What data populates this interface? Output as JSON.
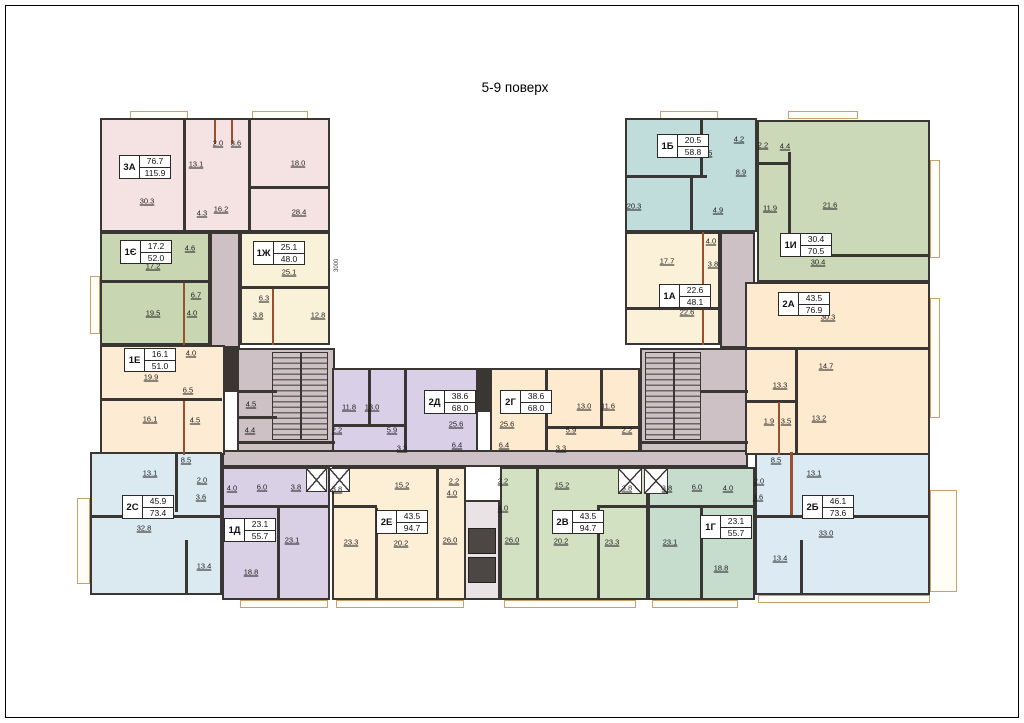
{
  "floor_label": "5-9 поверх",
  "palette": {
    "wall": "#3a3634",
    "partition": "#9b4f2c",
    "balcony_line": "#c9a26b",
    "corridor": "#cdc1c5",
    "paper": "#ffffff"
  },
  "plan": {
    "apartments": [
      {
        "id": "3А",
        "living": "76.7",
        "total": "115.9",
        "color": "#f5e3e3",
        "rect": [
          100,
          118,
          230,
          114
        ],
        "label": [
          119,
          155
        ],
        "rooms": [
          [
            "30.3",
            147,
            201
          ],
          [
            "13.1",
            196,
            164
          ],
          [
            "2.0",
            218,
            143
          ],
          [
            "3.6",
            236,
            143
          ],
          [
            "18.0",
            298,
            163
          ],
          [
            "4.3",
            202,
            213
          ],
          [
            "16.2",
            221,
            209
          ],
          [
            "28.4",
            299,
            212
          ]
        ]
      },
      {
        "id": "1Є",
        "living": "17.2",
        "total": "52.0",
        "color": "#c9d6b2",
        "rect": [
          100,
          232,
          110,
          113
        ],
        "label": [
          120,
          240
        ],
        "rooms": [
          [
            "17.2",
            153,
            266
          ],
          [
            "4.6",
            190,
            248
          ],
          [
            "6.7",
            196,
            295
          ],
          [
            "19.5",
            153,
            313
          ],
          [
            "4.0",
            192,
            313
          ]
        ]
      },
      {
        "id": "1Ж",
        "living": "25.1",
        "total": "48.0",
        "color": "#f9f2d8",
        "rect": [
          240,
          232,
          90,
          113
        ],
        "label": [
          253,
          241
        ],
        "rooms": [
          [
            "25.1",
            289,
            272
          ],
          [
            "6.3",
            264,
            298
          ],
          [
            "3.8",
            258,
            315
          ],
          [
            "12.8",
            318,
            315
          ]
        ]
      },
      {
        "id": "1Е",
        "living": "16.1",
        "total": "51.0",
        "color": "#fdecd3",
        "rect": [
          100,
          345,
          125,
          110
        ],
        "label": [
          124,
          348
        ],
        "rooms": [
          [
            "4.0",
            191,
            353
          ],
          [
            "19.9",
            151,
            377
          ],
          [
            "6.5",
            188,
            390
          ],
          [
            "16.1",
            150,
            419
          ],
          [
            "4.5",
            195,
            420
          ]
        ]
      },
      {
        "id": "2С",
        "living": "45.9",
        "total": "73.4",
        "color": "#dbe9f1",
        "rect": [
          90,
          452,
          132,
          143
        ],
        "label": [
          122,
          495
        ],
        "rooms": [
          [
            "8.5",
            186,
            460
          ],
          [
            "13.1",
            150,
            473
          ],
          [
            "2.0",
            202,
            480
          ],
          [
            "3.6",
            201,
            497
          ],
          [
            "32.8",
            144,
            528
          ],
          [
            "13.4",
            204,
            566
          ]
        ]
      },
      {
        "id": "1Д",
        "living": "23.1",
        "total": "55.7",
        "color": "#d9d0e5",
        "rect": [
          222,
          467,
          108,
          133
        ],
        "label": [
          224,
          518
        ],
        "rooms": [
          [
            "4.0",
            232,
            488
          ],
          [
            "6.0",
            262,
            487
          ],
          [
            "3.8",
            296,
            487
          ],
          [
            "23.1",
            292,
            540
          ],
          [
            "18.8",
            251,
            572
          ]
        ]
      },
      {
        "id": "2Е",
        "living": "43.5",
        "total": "94.7",
        "color": "#fdeed6",
        "rect": [
          332,
          467,
          134,
          133
        ],
        "label": [
          376,
          510
        ],
        "rooms": [
          [
            "3.8",
            337,
            489
          ],
          [
            "15.2",
            402,
            485
          ],
          [
            "2.2",
            454,
            481
          ],
          [
            "4.0",
            452,
            493
          ],
          [
            "23.3",
            351,
            542
          ],
          [
            "20.2",
            401,
            543
          ],
          [
            "26.0",
            450,
            540
          ]
        ]
      },
      {
        "id": "2Д",
        "living": "38.6",
        "total": "68.0",
        "color": "#d9d0e7",
        "rect": [
          332,
          368,
          146,
          84
        ],
        "label": [
          424,
          390
        ],
        "rooms": [
          [
            "11.8",
            349,
            407
          ],
          [
            "13.0",
            372,
            407
          ],
          [
            "2.2",
            337,
            430
          ],
          [
            "5.9",
            392,
            430
          ],
          [
            "3.3",
            402,
            448
          ],
          [
            "25.6",
            456,
            424
          ],
          [
            "6.4",
            457,
            445
          ]
        ]
      },
      {
        "id": "2Г",
        "living": "38.6",
        "total": "68.0",
        "color": "#fdeacf",
        "rect": [
          490,
          368,
          150,
          84
        ],
        "label": [
          500,
          390
        ],
        "rooms": [
          [
            "25.6",
            507,
            424
          ],
          [
            "6.4",
            504,
            445
          ],
          [
            "3.3",
            561,
            448
          ],
          [
            "5.9",
            571,
            430
          ],
          [
            "2.2",
            627,
            430
          ],
          [
            "13.0",
            584,
            406
          ],
          [
            "11.6",
            608,
            406
          ]
        ]
      },
      {
        "id": "2В",
        "living": "43.5",
        "total": "94.7",
        "color": "#d3e1c3",
        "rect": [
          500,
          467,
          148,
          133
        ],
        "label": [
          552,
          510
        ],
        "rooms": [
          [
            "2.2",
            503,
            481
          ],
          [
            "15.2",
            562,
            485
          ],
          [
            "4.0",
            503,
            508
          ],
          [
            "3.8",
            627,
            488
          ],
          [
            "26.0",
            512,
            540
          ],
          [
            "20.2",
            561,
            541
          ],
          [
            "23.3",
            612,
            542
          ]
        ]
      },
      {
        "id": "1Г",
        "living": "23.1",
        "total": "55.7",
        "color": "#c6dccd",
        "rect": [
          648,
          467,
          107,
          133
        ],
        "label": [
          700,
          515
        ],
        "rooms": [
          [
            "3.8",
            667,
            488
          ],
          [
            "6.0",
            697,
            487
          ],
          [
            "4.0",
            728,
            488
          ],
          [
            "23.1",
            670,
            542
          ],
          [
            "18.8",
            721,
            568
          ]
        ]
      },
      {
        "id": "2Б",
        "living": "46.1",
        "total": "73.6",
        "color": "#dcebf3",
        "rect": [
          755,
          452,
          175,
          143
        ],
        "label": [
          802,
          495
        ],
        "rooms": [
          [
            "8.5",
            776,
            460
          ],
          [
            "13.1",
            814,
            473
          ],
          [
            "2.0",
            759,
            481
          ],
          [
            "3.6",
            758,
            497
          ],
          [
            "33.0",
            826,
            533
          ],
          [
            "13.4",
            780,
            558
          ]
        ]
      },
      {
        "id": "1А",
        "living": "22.6",
        "total": "48.1",
        "color": "#faf1d8",
        "rect": [
          625,
          232,
          95,
          113
        ],
        "label": [
          659,
          284
        ],
        "rooms": [
          [
            "17.7",
            667,
            261
          ],
          [
            "4.0",
            711,
            241
          ],
          [
            "3.8",
            713,
            264
          ],
          [
            "22.6",
            687,
            312
          ]
        ]
      },
      {
        "id": "2А",
        "living": "43.5",
        "total": "76.9",
        "color": "#fdeacf",
        "rect": [
          745,
          282,
          185,
          173
        ],
        "label": [
          778,
          292
        ],
        "rooms": [
          [
            "30.3",
            828,
            317
          ],
          [
            "14.7",
            826,
            366
          ],
          [
            "13.3",
            780,
            385
          ],
          [
            "1.9",
            769,
            421
          ],
          [
            "3.5",
            786,
            421
          ],
          [
            "13.2",
            819,
            418
          ]
        ]
      },
      {
        "id": "1Б",
        "living": "20.5",
        "total": "58.8",
        "color": "#c0dcdb",
        "rect": [
          625,
          118,
          132,
          114
        ],
        "label": [
          657,
          134
        ],
        "rooms": [
          [
            "20.5",
            705,
            153
          ],
          [
            "4.2",
            739,
            139
          ],
          [
            "8.9",
            741,
            172
          ],
          [
            "20.3",
            634,
            206
          ],
          [
            "4.9",
            718,
            210
          ]
        ]
      },
      {
        "id": "1И",
        "living": "30.4",
        "total": "70.5",
        "color": "#ccd9b8",
        "rect": [
          757,
          120,
          173,
          162
        ],
        "label": [
          780,
          233
        ],
        "rooms": [
          [
            "2.2",
            763,
            145
          ],
          [
            "4.4",
            785,
            146
          ],
          [
            "11.9",
            770,
            208
          ],
          [
            "21.6",
            830,
            205
          ],
          [
            "30.4",
            818,
            262
          ]
        ]
      }
    ],
    "corridors": [
      [
        210,
        232,
        30,
        116
      ],
      [
        237,
        348,
        98,
        104
      ],
      [
        222,
        450,
        526,
        17
      ],
      [
        640,
        348,
        108,
        104
      ],
      [
        720,
        232,
        35,
        116
      ]
    ],
    "corridor_rooms": [
      [
        "4.5",
        251,
        404
      ],
      [
        "4.4",
        250,
        430
      ]
    ],
    "stairs": [
      [
        272,
        352,
        56,
        88
      ],
      [
        645,
        352,
        56,
        88
      ]
    ],
    "shafts": [
      [
        306,
        468,
        21,
        24
      ],
      [
        329,
        468,
        21,
        24
      ],
      [
        618,
        468,
        24,
        26
      ],
      [
        644,
        468,
        24,
        26
      ]
    ],
    "elevator": {
      "box": [
        464,
        500,
        36,
        100
      ],
      "cars": [
        [
          468,
          528,
          28,
          26
        ],
        [
          468,
          557,
          28,
          26
        ]
      ]
    },
    "walls": [
      [
        183,
        120,
        3,
        112,
        "d"
      ],
      [
        248,
        120,
        3,
        112,
        "d"
      ],
      [
        251,
        186,
        79,
        3,
        "d"
      ],
      [
        214,
        120,
        2,
        24,
        "b"
      ],
      [
        231,
        120,
        2,
        24,
        "b"
      ],
      [
        100,
        280,
        108,
        3,
        "d"
      ],
      [
        183,
        283,
        2,
        62,
        "b"
      ],
      [
        240,
        286,
        88,
        3,
        "d"
      ],
      [
        272,
        289,
        2,
        56,
        "b"
      ],
      [
        100,
        398,
        122,
        3,
        "d"
      ],
      [
        183,
        401,
        2,
        54,
        "b"
      ],
      [
        175,
        452,
        3,
        60,
        "d"
      ],
      [
        90,
        515,
        132,
        3,
        "d"
      ],
      [
        185,
        540,
        3,
        55,
        "d"
      ],
      [
        222,
        505,
        108,
        3,
        "d"
      ],
      [
        277,
        508,
        3,
        92,
        "d"
      ],
      [
        436,
        467,
        3,
        133,
        "d"
      ],
      [
        375,
        508,
        3,
        92,
        "d"
      ],
      [
        332,
        505,
        45,
        3,
        "d"
      ],
      [
        368,
        368,
        3,
        56,
        "d"
      ],
      [
        404,
        368,
        3,
        84,
        "d"
      ],
      [
        332,
        424,
        72,
        3,
        "d"
      ],
      [
        545,
        368,
        3,
        84,
        "d"
      ],
      [
        600,
        368,
        3,
        58,
        "d"
      ],
      [
        545,
        426,
        95,
        3,
        "d"
      ],
      [
        536,
        467,
        3,
        133,
        "d"
      ],
      [
        597,
        508,
        3,
        92,
        "d"
      ],
      [
        597,
        505,
        50,
        3,
        "d"
      ],
      [
        648,
        505,
        107,
        3,
        "d"
      ],
      [
        700,
        508,
        3,
        92,
        "d"
      ],
      [
        755,
        515,
        175,
        3,
        "d"
      ],
      [
        800,
        540,
        3,
        55,
        "d"
      ],
      [
        790,
        452,
        3,
        63,
        "b"
      ],
      [
        702,
        232,
        2,
        113,
        "b"
      ],
      [
        625,
        307,
        95,
        3,
        "d"
      ],
      [
        745,
        347,
        185,
        3,
        "d"
      ],
      [
        795,
        349,
        3,
        106,
        "d"
      ],
      [
        745,
        400,
        52,
        3,
        "d"
      ],
      [
        778,
        402,
        2,
        53,
        "b"
      ],
      [
        625,
        175,
        82,
        3,
        "d"
      ],
      [
        690,
        177,
        3,
        55,
        "d"
      ],
      [
        700,
        120,
        3,
        55,
        "d"
      ],
      [
        788,
        152,
        3,
        102,
        "d"
      ],
      [
        757,
        162,
        32,
        3,
        "d"
      ],
      [
        790,
        254,
        140,
        3,
        "d"
      ],
      [
        225,
        348,
        12,
        44,
        "d"
      ],
      [
        478,
        368,
        12,
        44,
        "d"
      ],
      [
        237,
        390,
        40,
        3,
        "d"
      ],
      [
        237,
        416,
        40,
        3,
        "d"
      ],
      [
        237,
        441,
        98,
        3,
        "d"
      ],
      [
        700,
        390,
        48,
        3,
        "d"
      ],
      [
        640,
        441,
        108,
        3,
        "d"
      ]
    ],
    "balconies": [
      [
        130,
        111,
        58,
        8
      ],
      [
        252,
        111,
        56,
        8
      ],
      [
        660,
        111,
        58,
        8
      ],
      [
        788,
        111,
        70,
        8
      ],
      [
        90,
        276,
        10,
        58
      ],
      [
        77,
        498,
        13,
        86
      ],
      [
        240,
        600,
        88,
        8
      ],
      [
        336,
        600,
        128,
        8
      ],
      [
        504,
        600,
        132,
        8
      ],
      [
        652,
        600,
        86,
        8
      ],
      [
        758,
        595,
        172,
        8
      ],
      [
        930,
        160,
        10,
        98
      ],
      [
        930,
        298,
        10,
        120
      ],
      [
        930,
        490,
        27,
        102
      ]
    ],
    "dimensions": [
      {
        "text": "3000",
        "x": 334,
        "y": 272
      }
    ]
  }
}
